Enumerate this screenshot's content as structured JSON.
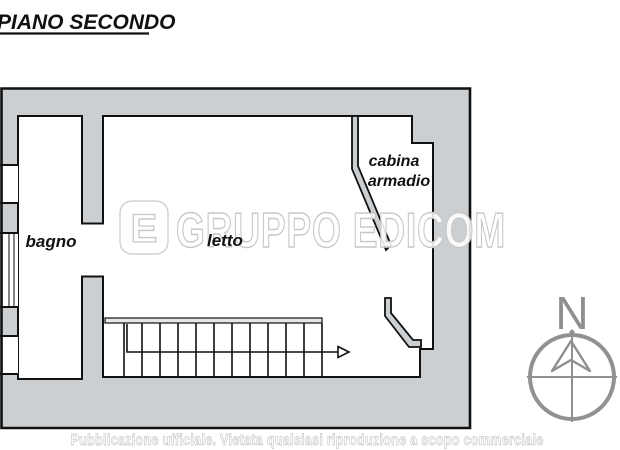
{
  "title": "PIANO SECONDO",
  "rooms": {
    "bagno": "bagno",
    "letto": "letto",
    "cabina_line1": "cabina",
    "cabina_line2": "armadio"
  },
  "watermark": {
    "brand": "GRUPPO EDICOM",
    "logo_letter": "E"
  },
  "compass": {
    "north_label": "N"
  },
  "footer": {
    "disclaimer": "Pubblicazione ufficiale. Vietata qualsiasi riproduzione a scopo commerciale"
  },
  "colors": {
    "wall_fill": "#cbcfd1",
    "line": "#111111",
    "compass_gray": "#8f8f8f",
    "watermark_gray": "#c8c8c8"
  }
}
